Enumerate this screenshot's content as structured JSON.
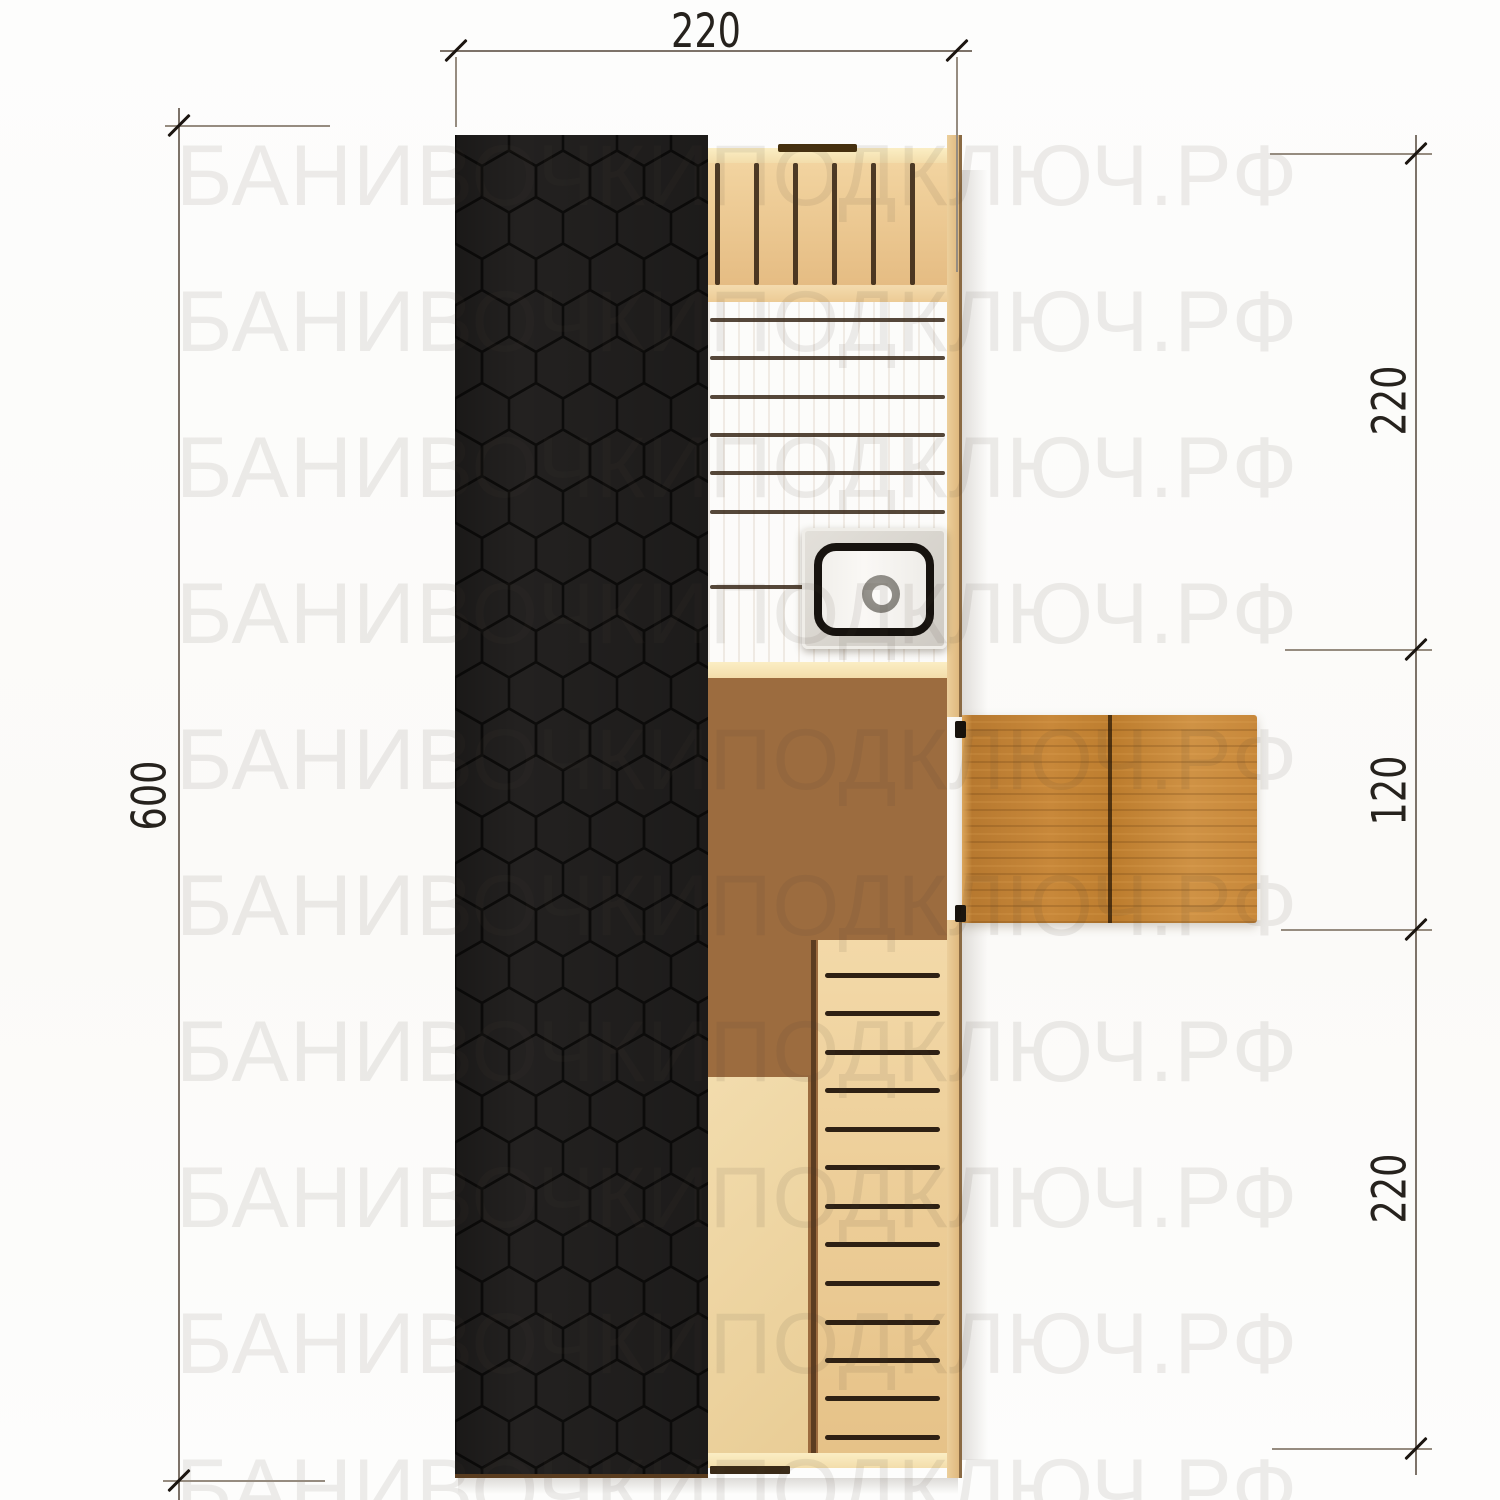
{
  "title": "Barrel sauna floor plan — top view",
  "watermark": {
    "text": "БАНИВОЧКИПОДКЛЮЧ.РФ",
    "rows": 10
  },
  "dimensions": {
    "top": {
      "label": "220"
    },
    "left": {
      "label": "600"
    },
    "right": [
      {
        "label": "220"
      },
      {
        "label": "120"
      },
      {
        "label": "220"
      }
    ]
  },
  "areas": {
    "roof": "roof membrane with hexagonal shingles",
    "steam_room_bench": "upper bench planks",
    "stove": "stove with chimney",
    "middle_room": "walnut floor room",
    "deck": "entrance deck",
    "lower_room": "slatted walkway and bench"
  },
  "colors": {
    "roof": "#232120",
    "roof_line": "#0d0c0b",
    "bench_light": "#eccb97",
    "floor_mid": "#d9a462",
    "walnut": "#9c6c3f",
    "deck": "#c8883a",
    "wall_pale": "#f6e3b4",
    "gap_dark": "#31200f",
    "stove_metal": "#d8d4cf",
    "stove_ring": "#17130f",
    "dim_text": "#26221d",
    "watermark": "#ecebe9"
  }
}
